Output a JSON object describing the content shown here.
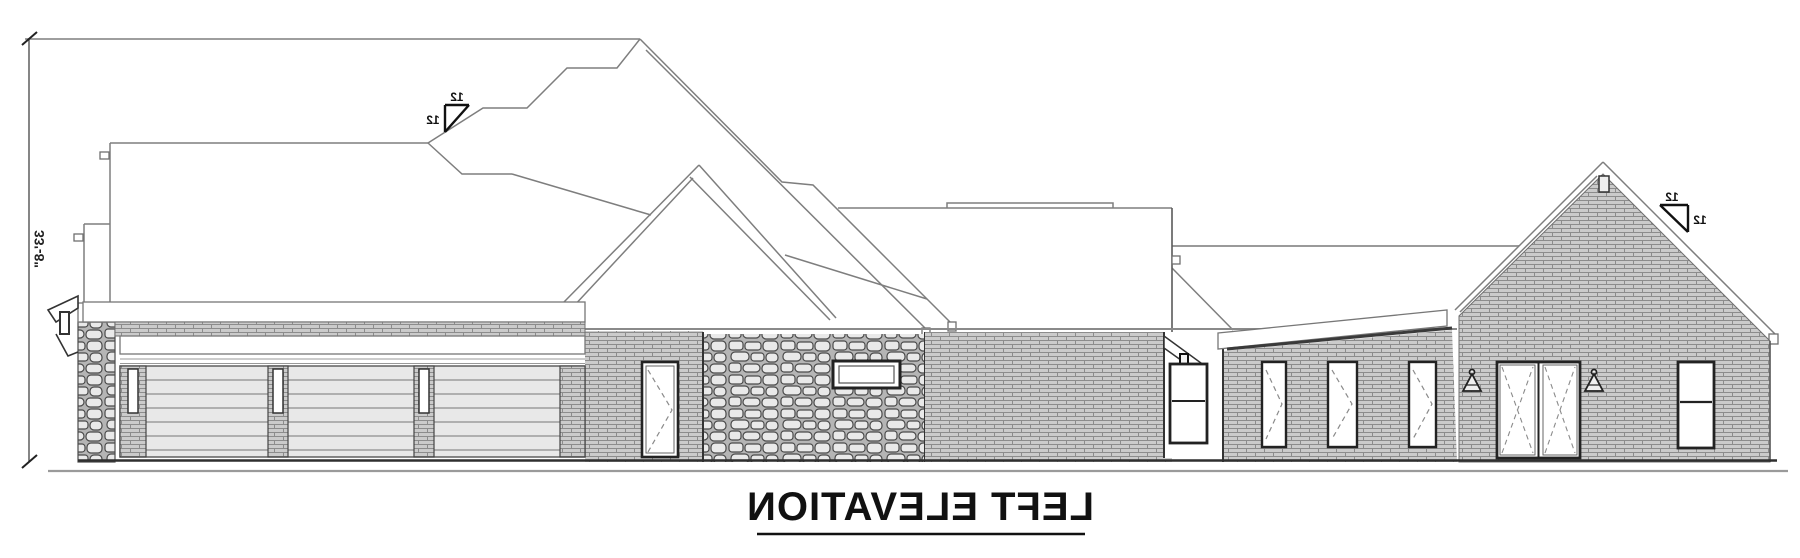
{
  "drawing": {
    "title": "LEFT ELEVATION",
    "height_dimension": "33'-8\"",
    "roof_pitch": {
      "left_marker": {
        "rise": "12",
        "run": "12"
      },
      "right_marker": {
        "rise": "12",
        "run": "12"
      }
    },
    "colors": {
      "background": "#ffffff",
      "roof_line": "#7a7a7a",
      "dark_line": "#222222",
      "brick": "#cccccc",
      "stone": "#e9e9e9",
      "garage_door": "#e8e8e8"
    }
  }
}
